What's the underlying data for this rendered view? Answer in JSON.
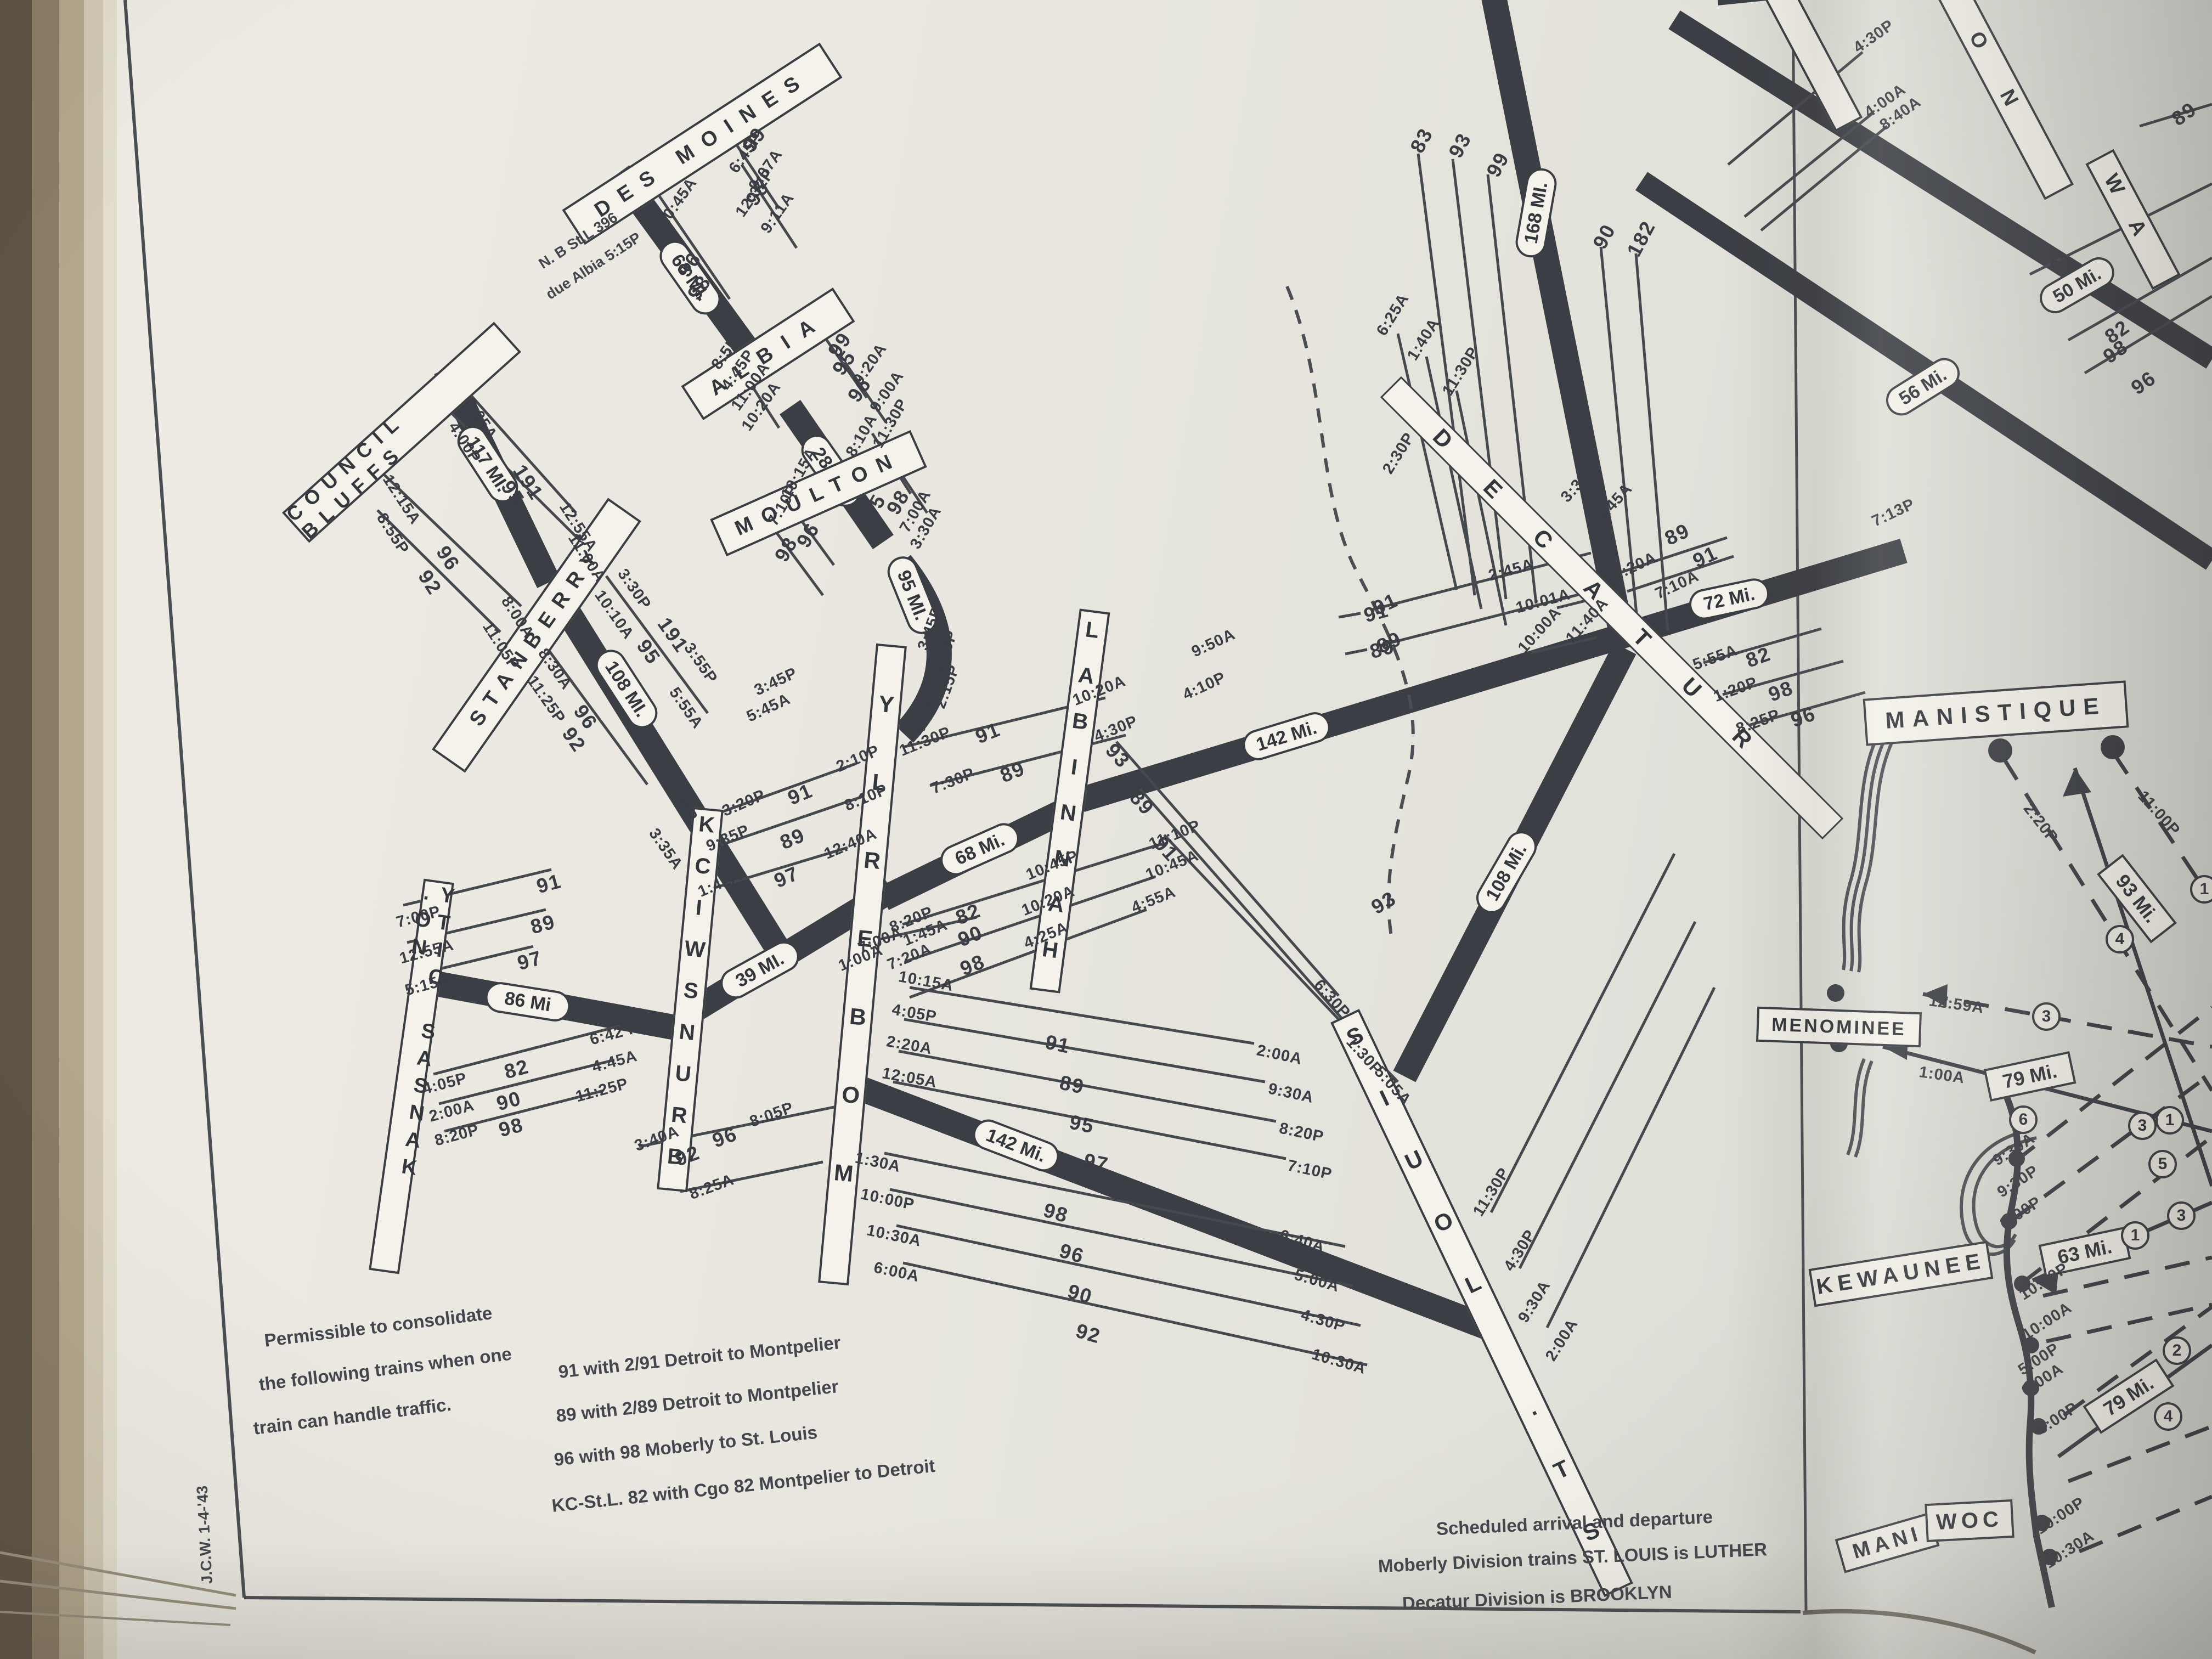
{
  "stations": {
    "des_moines": "DES MOINES",
    "albia": "ALBIA",
    "moulton": "MOULTON",
    "council_bluffs": "COUNCIL BLUFFS",
    "stanberry": "STANBERRY",
    "no_kansas_city": "NO. KANSAS CITY",
    "brunswick": "BRUNSWICK",
    "moberly": "MOBERLY",
    "hannibal": "HANNIBAL",
    "st_louis": "ST. LOUIS",
    "decatur": "DECATUR",
    "manistique": "MANISTIQUE",
    "menominee": "MENOMINEE",
    "kewaunee": "KEWAUNEE",
    "manitowoc_left": "MANI",
    "manitowoc_right": "WOC",
    "partial_top_right_1": "ON",
    "partial_top_right_2": "WA"
  },
  "mileages": {
    "cb_stanberry": "117 MI.",
    "stanberry_main": "108 MI.",
    "kc_brunswick": "86 Mi",
    "brunswick_moberly": "39 MI.",
    "desmoines_albia": "68 MI.",
    "albia_moulton": "28 MI.",
    "moulton_moberly": "95 MI.",
    "moberly_hannibal": "68 Mi.",
    "hannibal_decatur": "142 Mi.",
    "moberly_stlouis": "142 Mi.",
    "stlouis_decatur": "108 Mi.",
    "decatur_north": "168 MI.",
    "decatur_east": "72 Mi.",
    "topright_a": "50 Mi.",
    "topright_b": "56 Mi.",
    "ferry_manistique": "93 Mi.",
    "ferry_menominee": "79 Mi.",
    "ferry_kewaunee": "63 Mi.",
    "ferry_manitowoc": "79 Mi."
  },
  "notes": {
    "consolidate": [
      "Permissible to consolidate",
      "the following trains when one",
      "train can handle traffic."
    ],
    "consolidate_items": [
      "91 with 2/91 Detroit to Montpelier",
      "89 with 2/89 Detroit to Montpelier",
      "96 with 98 Moberly to St. Louis",
      "KC-St.L. 82 with Cgo 82 Montpelier to Detroit"
    ],
    "schedule": [
      "Scheduled arrival and departure",
      "Moberly Division trains ST. LOUIS is LUTHER",
      "Decatur Division is BROOKLYN"
    ],
    "albia_note": [
      "N. B St.L 396",
      "due Albia 5:15P"
    ],
    "credit": "J.C.W. 1-4-'43"
  },
  "circles": [
    "1",
    "4",
    "3",
    "6",
    "1",
    "3",
    "5",
    "1",
    "3",
    "2",
    "4"
  ],
  "labels": [
    "99",
    "6:45P",
    "9:07A",
    "95",
    "12:32P",
    "9:11A",
    "10:45A",
    "96",
    "98",
    "8:55P",
    "4:45P",
    "11:00A",
    "10:20A",
    "99",
    "95",
    "9:20A",
    "96",
    "9:00A",
    "10:15A",
    "96",
    "7:10P",
    "98",
    "11:30P",
    "98",
    "8:10A",
    "95",
    "7:00A",
    "3:30A",
    "3:45P",
    "11:10P",
    "2:15P",
    "4:30A",
    "3:45P",
    "5:45A",
    "9:05A",
    "191",
    "4:00P",
    "95",
    "12:55A",
    "11:00A",
    "12:15A",
    "96",
    "8:55P",
    "92",
    "8:00A",
    "11:05P",
    "3:30P",
    "191",
    "3:55P",
    "10:10A",
    "95",
    "5:55A",
    "8:30A",
    "96",
    "11:25P",
    "92",
    "3:05P",
    "3:35A",
    "7:00P",
    "91",
    "12:55A",
    "89",
    "5:15A",
    "97",
    "4:05P",
    "82",
    "6:42 P.",
    "4:45A",
    "2:00A",
    "90",
    "11:25P",
    "8:20P",
    "98",
    "3:40A",
    "92",
    "96",
    "8:05P",
    "8:25A",
    "3:20P",
    "91",
    "2:10P",
    "9:35P",
    "89",
    "8:10P",
    "1:42A",
    "97",
    "12:40A",
    "11:30P",
    "91",
    "10:20A",
    "7:30P",
    "89",
    "4:30P",
    "8:20P",
    "82",
    "10:45P",
    "7:20A",
    "90",
    "10:20A",
    "98",
    "4:25A",
    "11:10P",
    "10:45A",
    "4:55A",
    "9:50A",
    "4:10P",
    "91",
    "89",
    "93",
    "89",
    "91",
    "6:30P",
    "1:30P",
    "5:05A",
    "7:00A",
    "1:45A",
    "1:00A",
    "10:15A",
    "91",
    "2:00A",
    "4:05P",
    "89",
    "9:30A",
    "2:20A",
    "95",
    "8:20P",
    "12:05A",
    "97",
    "7:10P",
    "1:30A",
    "98",
    "10:00P",
    "96",
    "10:30A",
    "90",
    "6:00A",
    "92",
    "6:40A",
    "5:00A",
    "4:30P",
    "10:30A",
    "11:30P",
    "4:30P",
    "9:30A",
    "2:00A",
    "93",
    "6:25A",
    "1:40A",
    "11:30P",
    "2:30P",
    "2:45A",
    "91",
    "10:01A",
    "89",
    "10:00A",
    "11:40A",
    "3:30P",
    "9:45A",
    "9:20A",
    "89",
    "7:10A",
    "91",
    "83",
    "93",
    "99",
    "90",
    "182",
    "5:55A",
    "82",
    "1:20P",
    "98",
    "8:25P",
    "96",
    "7:13P",
    "4:30P",
    "4:00A",
    "8:40A",
    "89",
    "91",
    "82",
    "98",
    "96",
    "2:20P",
    "11:00P",
    "12:59A",
    "1:00A",
    "9:30A",
    "9:30P",
    "3:00P",
    "10:00P",
    "10:00A",
    "5:00P",
    "6:00A",
    "6:00P",
    "10:00P",
    "10:30A"
  ]
}
